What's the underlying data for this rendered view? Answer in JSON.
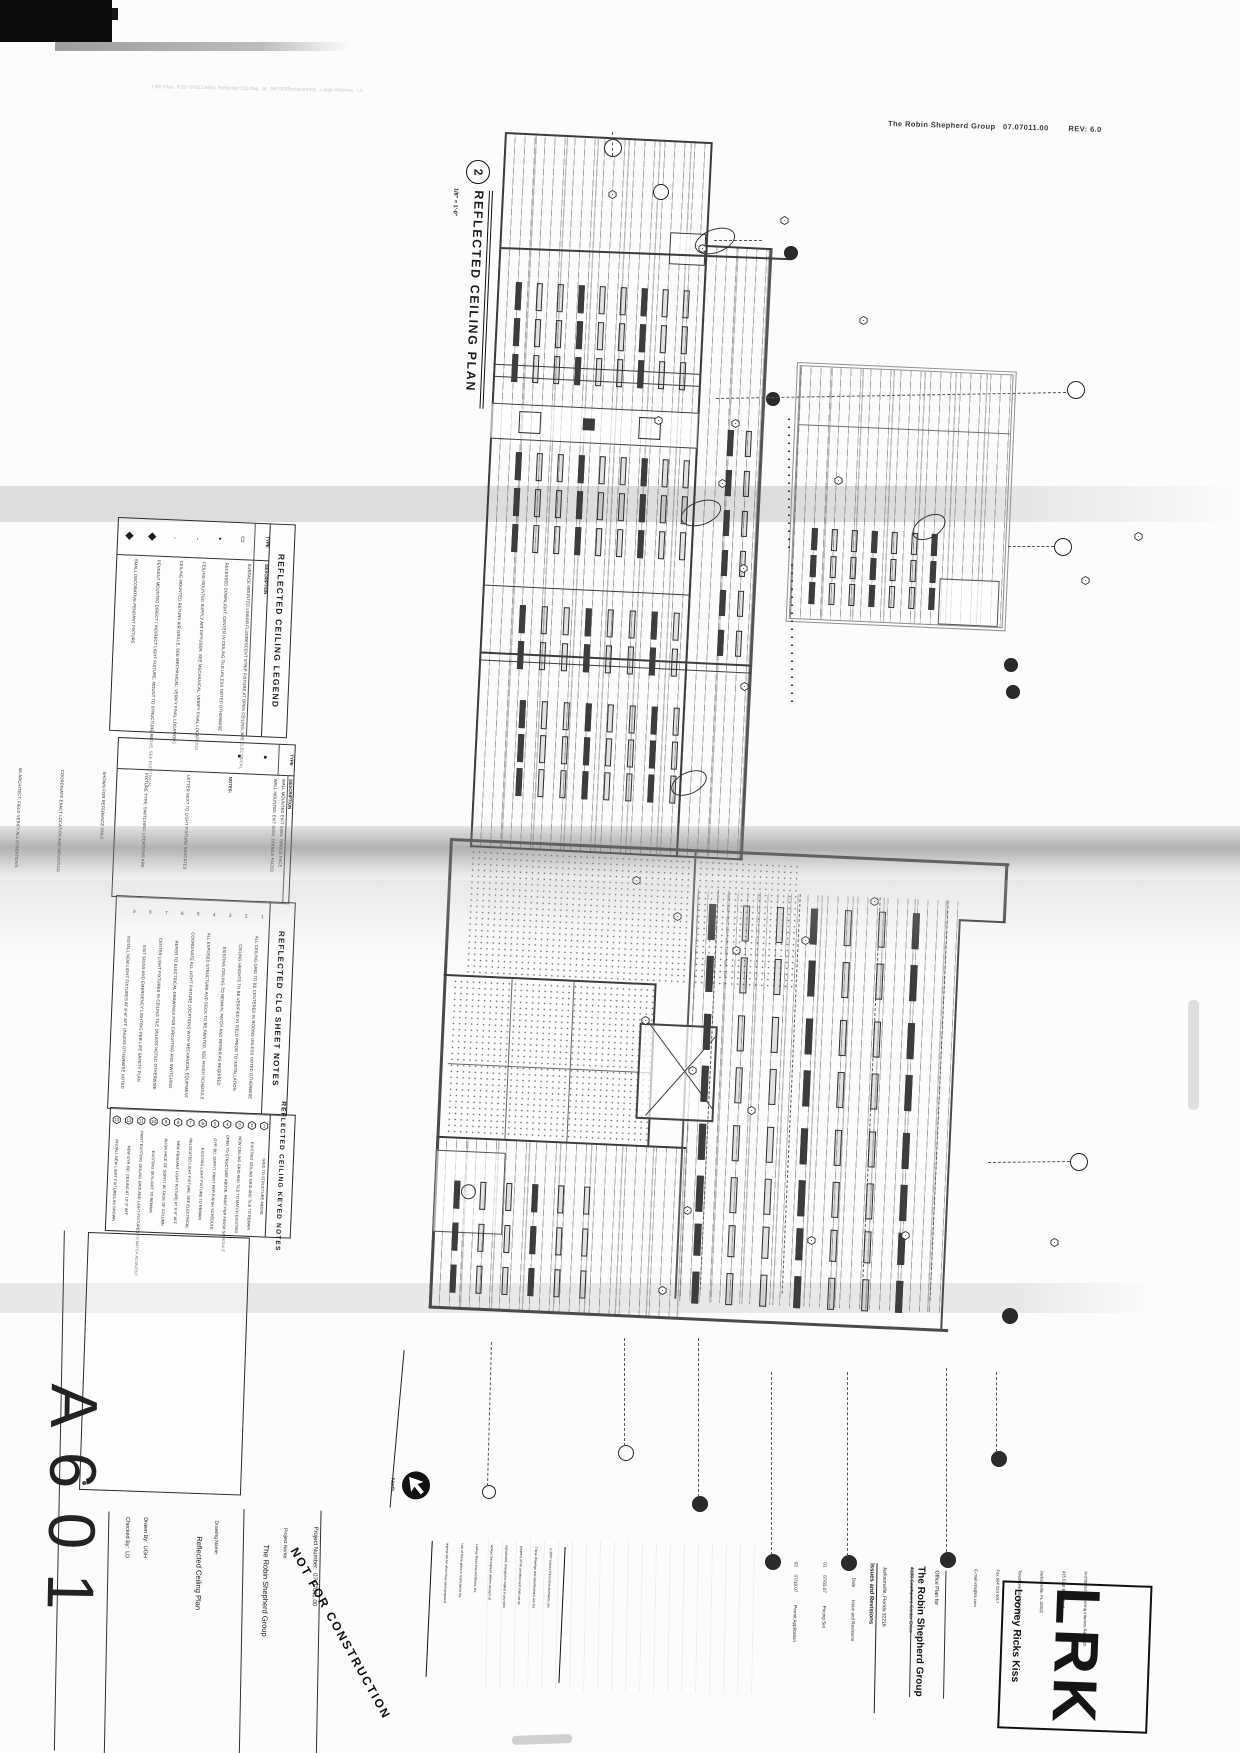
{
  "scan": {
    "plot_stamp": "LRK Files  P:\\07-07011\\A601 Reflected Clg.dwg   at   MOSDPlotAssembly   Large Antenna   Ln",
    "top_right_stamp": "The Robin Shepherd Group   07.07011.00        REV: 6.0"
  },
  "drawing_title": {
    "number": "2",
    "label": "REFLECTED CEILING PLAN",
    "scale": "1/8\" = 1'-0\""
  },
  "legend": {
    "title": "REFLECTED CEILING LEGEND",
    "col_type": "TYPE",
    "col_desc": "DESCRIPTION",
    "rows": [
      {
        "symbol": "▯",
        "desc": "SURFACE MOUNTED LINEAR FLUORESCENT STRIP FIXTURE AT OPEN CEILING, SEE ELECTRICAL"
      },
      {
        "symbol": "•",
        "desc": "RECESSED DOWNLIGHT, CENTER IN CEILING TILE UNLESS NOTED OTHERWISE"
      },
      {
        "symbol": "·",
        "desc": "CEILING MOUNTED SUPPLY AIR DIFFUSER, SEE MECHANICAL; VERIFY FINAL LOCATIONS"
      },
      {
        "symbol": "·",
        "desc": "CEILING MOUNTED RETURN AIR GRILLE, SEE MECHANICAL; VERIFY FINAL LOCATIONS"
      },
      {
        "symbol": "◆",
        "desc": "PENDANT MOUNTED DIRECT / INDIRECT LIGHT FIXTURE, MOUNT TO STRUCTURE ABOVE, SEE ELECTRICAL"
      },
      {
        "symbol": "◆",
        "desc": "SMALL DECORATIVE PENDANT FIXTURE"
      }
    ]
  },
  "legend2": {
    "col_type": "TYPE",
    "col_desc": "DESCRIPTION",
    "rows": [
      {
        "symbol": "●",
        "desc": "WALL MOUNTED EXIT SIGN, SINGLE FACE"
      },
      {
        "symbol": "●",
        "desc": "WALL MOUNTED EXIT SIGN, DOUBLE FACED"
      }
    ],
    "notes": [
      "NOTES:",
      "LETTER NEXT TO LIGHT FIXTURE INDICATES",
      "FIXTURE TYPE; SWITCHING LOCATIONS ARE",
      "SHOWN FOR REFERENCE ONLY.",
      "COORDINATE EXACT LOCATION AND MOUNTING",
      "W/ ARCHITECT; FIELD VERIFY ALL CONDITIONS",
      "W/ ELECTRICAL AND DRYWALL CONTRACTORS."
    ]
  },
  "sheet_notes": {
    "title": "REFLECTED CLG SHEET NOTES",
    "items": [
      {
        "n": "1",
        "text": "ALL CEILING GRID TO BE CENTERED IN ROOMS UNLESS NOTED OTHERWISE"
      },
      {
        "n": "2",
        "text": "CEILING HEIGHTS TO BE VERIFIED IN FIELD PRIOR TO INSTALLATION"
      },
      {
        "n": "3",
        "text": "EXISTING CEILING TO REMAIN; PATCH AND REPAIR AS REQUIRED"
      },
      {
        "n": "4",
        "text": "ALL EXPOSED STRUCTURE AND DECK TO BE PAINTED, SEE FINISH SCHEDULE"
      },
      {
        "n": "5",
        "text": "COORDINATE ALL LIGHT FIXTURE LOCATIONS WITH MECHANICAL EQUIPMENT"
      },
      {
        "n": "6",
        "text": "REFER TO ELECTRICAL DRAWINGS FOR CIRCUITING AND SWITCHING"
      },
      {
        "n": "7",
        "text": "CENTER LIGHT FIXTURES IN CEILING TILE UNLESS NOTED OTHERWISE"
      },
      {
        "n": "8",
        "text": "EXIT SIGNS AND EMERGENCY LIGHTING PER LIFE SAFETY PLAN"
      },
      {
        "n": "9",
        "text": "INSTALL NEW LIGHT FIXTURES AT 9'-6\" AFF UNLESS OTHERWISE NOTED"
      }
    ]
  },
  "keyed_notes": {
    "title": "REFLECTED CEILING KEYED NOTES",
    "items": [
      {
        "n": "1",
        "text": "GRID TO STRUCTURE ABOVE"
      },
      {
        "n": "2",
        "text": "EXISTING CEILING GRID AND TILE TO REMAIN"
      },
      {
        "n": "3",
        "text": "NEW CEILING GRID AND TILE TO MATCH EXISTING"
      },
      {
        "n": "4",
        "text": "OPEN TO STRUCTURE ABOVE, PAINT PER FINISH SCHEDULE"
      },
      {
        "n": "5",
        "text": "GYP. BD. SOFFIT, PAINT PER FINISH SCHEDULE"
      },
      {
        "n": "6",
        "text": "EXISTING LIGHT FIXTURE TO REMAIN"
      },
      {
        "n": "7",
        "text": "RELOCATED LIGHT FIXTURE, SEE ELECTRICAL"
      },
      {
        "n": "8",
        "text": "NEW PENDANT LIGHT FIXTURE AT 9'-0\" AFF"
      },
      {
        "n": "9",
        "text": "ALIGN FACE OF SOFFIT W/ FACE OF COLUMN"
      },
      {
        "n": "10",
        "text": "EXISTING SKYLIGHT TO REMAIN"
      },
      {
        "n": "11",
        "text": "PAINT EXISTING CEILING GRID AND LIGHT FIXTURES TO MATCH ADJACENT"
      },
      {
        "n": "12",
        "text": "NEW GYP. BD. CEILING AT 10'-0\" AFF"
      },
      {
        "n": "13",
        "text": "INSTALL NEW LIGHT FIXTURES AS SHOWN"
      }
    ]
  },
  "titleblock": {
    "sheet_number": "A601",
    "drawn_by_label": "Drawn By:",
    "drawn_by": "UGH",
    "checked_by_label": "Checked By:",
    "checked_by": "LD",
    "drawing_name_label": "Drawing Name:",
    "drawing_name": "Reflected Ceiling Plan",
    "project_name_label": "Project Name:",
    "project_name": "The Robin Shepherd Group",
    "project_number_label": "Project Number:",
    "project_number": "07.07011.00",
    "stamp": "NOT FOR CONSTRUCTION",
    "north_label": "North",
    "copyright_lines": [
      "©2007 Looney Ricks Kiss Architects, Inc.",
      "These drawings and specifications are the",
      "property of the architect and shall not be",
      "reproduced, changed or copied in any form",
      "without the express written consent of",
      "Looney Ricks Kiss Architects, Inc.",
      "Use of these plans is restricted to the",
      "original site for which they were prepared."
    ]
  },
  "revisions": {
    "title": "Issues and Revisions",
    "col_no": "No.",
    "col_date": "Date",
    "col_desc": "Issue and Revisions",
    "rows": [
      {
        "no": "01",
        "date": "07/05.07",
        "desc": "Pricing Set"
      },
      {
        "no": "02",
        "date": "07/18.07",
        "desc": "Permit Application"
      }
    ]
  },
  "client": {
    "office_plan_label": "Office Plan for",
    "name": "The Robin Shepherd Group",
    "address_lines": [
      "4100 Southpoint Center Drive",
      "Jacksonville, Florida 32216"
    ]
  },
  "firm": {
    "logo": "LRK",
    "name": "Looney Ricks Kiss",
    "address_lines": [
      "Architecture Planning Interiors Research",
      "415 East Bay Street",
      "Jacksonville, FL 32202",
      "Telephone 904 201 1044",
      "Fax 904 224 4617",
      "E-mail info@lrk.com"
    ]
  },
  "plan": {
    "fixture_clusters": [
      [
        516,
        282,
        9,
        3,
        4,
        26,
        21,
        36,
        "pg"
      ],
      [
        516,
        452,
        9,
        3,
        4,
        26,
        21,
        36,
        "pg"
      ],
      [
        520,
        605,
        8,
        2,
        4,
        26,
        22,
        36,
        "pg"
      ],
      [
        520,
        700,
        8,
        3,
        4,
        26,
        22,
        34,
        "pg"
      ],
      [
        728,
        430,
        2,
        6,
        4,
        24,
        18,
        40,
        "pg"
      ],
      [
        812,
        528,
        7,
        3,
        4,
        20,
        20,
        27,
        "pg"
      ],
      [
        262,
        54,
        7,
        2,
        5,
        34,
        34,
        52,
        "p3"
      ],
      [
        262,
        164,
        7,
        2,
        5,
        34,
        34,
        52,
        "p3"
      ],
      [
        262,
        274,
        7,
        2,
        5,
        34,
        34,
        52,
        "p3"
      ],
      [
        262,
        374,
        7,
        2,
        5,
        30,
        34,
        48,
        "p3"
      ],
      [
        20,
        342,
        6,
        2,
        4,
        26,
        26,
        42,
        "p3"
      ],
      [
        20,
        426,
        6,
        1,
        4,
        26,
        26,
        42,
        "p3"
      ]
    ],
    "symbols": [
      [
        608,
        186
      ],
      [
        689,
        240
      ],
      [
        700,
        475
      ],
      [
        712,
        560
      ],
      [
        704,
        678
      ],
      [
        735,
        212
      ],
      [
        600,
        412
      ],
      [
        668,
        415
      ],
      [
        560,
        872
      ],
      [
        592,
        908
      ],
      [
        642,
        942
      ],
      [
        702,
        932
      ],
      [
        762,
        893
      ],
      [
        524,
        1012
      ],
      [
        562,
        1062
      ],
      [
        612,
        1102
      ],
      [
        663,
        1232
      ],
      [
        748,
        1227
      ],
      [
        888,
        1234
      ],
      [
        512,
        1202
      ],
      [
        478,
        1282
      ],
      [
        892,
        572
      ],
      [
        936,
        528
      ],
      [
        652,
        312
      ],
      [
        618,
        472
      ]
    ],
    "bubbles": [
      [
        612,
        147,
        8,
        0
      ],
      [
        660,
        191,
        7,
        0
      ],
      [
        790,
        252,
        6,
        1
      ],
      [
        772,
        398,
        6,
        1
      ],
      [
        1075,
        389,
        8,
        0
      ],
      [
        1062,
        546,
        8,
        0
      ],
      [
        1010,
        664,
        6,
        1
      ],
      [
        1012,
        691,
        6,
        1
      ],
      [
        1078,
        1161,
        8,
        0
      ],
      [
        1009,
        1315,
        7,
        1
      ],
      [
        625,
        1452,
        7,
        0
      ],
      [
        488,
        1491,
        6,
        0
      ],
      [
        699,
        1503,
        7,
        1
      ],
      [
        772,
        1561,
        7,
        1
      ],
      [
        848,
        1562,
        7,
        1
      ],
      [
        947,
        1559,
        7,
        1
      ],
      [
        998,
        1458,
        7,
        1
      ]
    ],
    "leaders": [
      [
        714,
        240,
        762,
        240
      ],
      [
        716,
        398,
        1066,
        392
      ],
      [
        1008,
        546,
        1054,
        546
      ],
      [
        988,
        1162,
        1070,
        1161
      ],
      [
        625,
        1338,
        625,
        1446
      ],
      [
        492,
        1342,
        488,
        1486
      ],
      [
        699,
        1338,
        699,
        1497
      ],
      [
        772,
        1372,
        772,
        1555
      ],
      [
        848,
        1372,
        848,
        1556
      ],
      [
        947,
        1368,
        947,
        1552
      ],
      [
        997,
        1372,
        997,
        1452
      ],
      [
        612,
        156,
        612,
        132
      ]
    ],
    "ovals": [
      [
        714,
        240,
        11,
        20,
        70
      ],
      [
        700,
        512,
        11,
        20,
        70
      ],
      [
        688,
        782,
        10,
        18,
        65
      ],
      [
        928,
        526,
        10,
        17,
        60
      ]
    ],
    "dotlines": [
      [
        788,
        418,
        130
      ],
      [
        791,
        562,
        140
      ]
    ]
  }
}
